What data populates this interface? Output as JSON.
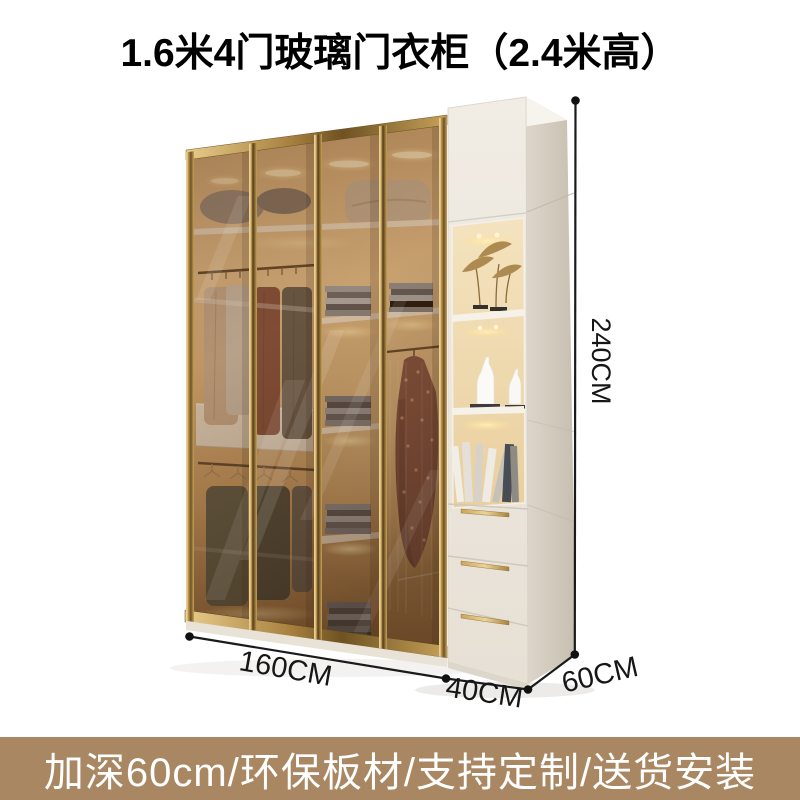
{
  "title": "1.6米4门玻璃门衣柜（2.4米高）",
  "dimensions": {
    "height": "240CM",
    "main_width": "160CM",
    "side_cabinet_width": "40CM",
    "depth": "60CM"
  },
  "banner": {
    "text": "加深60cm/环保板材/支持定制/送货安装"
  },
  "colors": {
    "banner_background": "#a98762",
    "banner_text": "#ffffff",
    "title_text": "#000000",
    "dimension_annotation": "#161616",
    "gold_frame": "#b9945c",
    "glass_tint": "#8a5c32",
    "cabinet_body": "#ece7de",
    "interior_glow": "#f0d0a0"
  }
}
